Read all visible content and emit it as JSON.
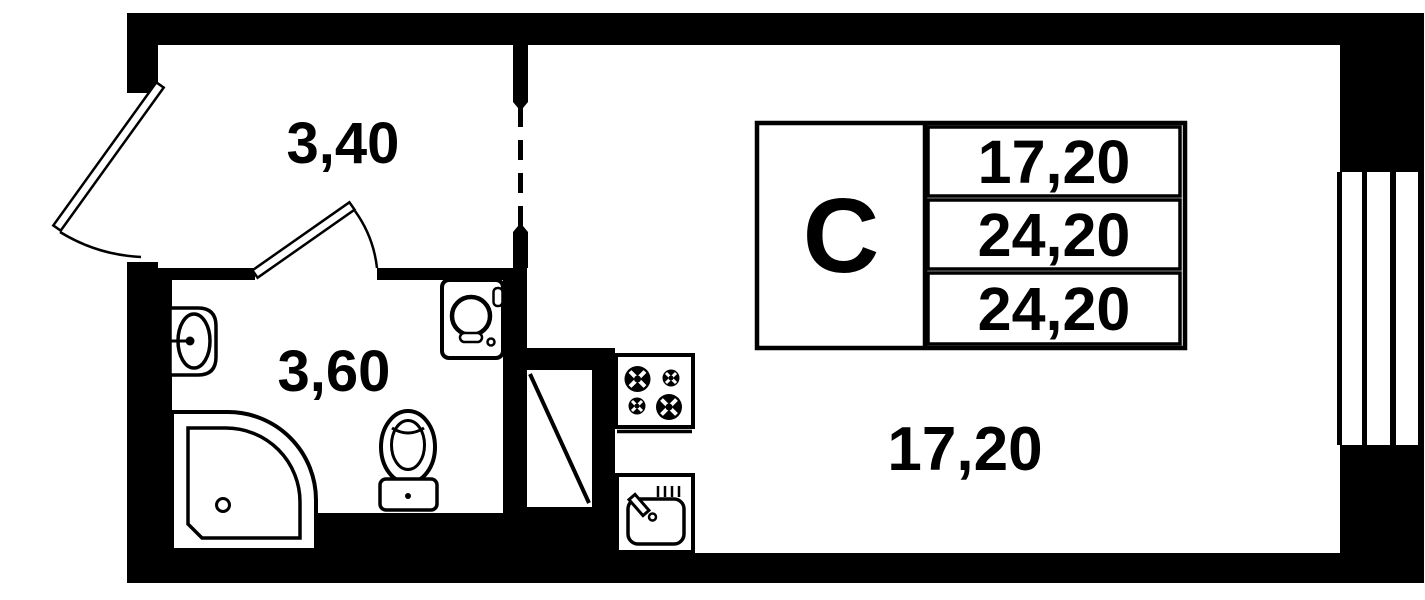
{
  "plan": {
    "labels": {
      "hallway": "3,40",
      "bathroom": "3,60",
      "living_room": "17,20"
    },
    "stamp": {
      "letter": "С",
      "rows": [
        "17,20",
        "24,20",
        "24,20"
      ]
    },
    "colors": {
      "wall": "#000000",
      "background": "#ffffff"
    },
    "fixtures": [
      "entry-door",
      "interior-door",
      "doorway-opening",
      "window",
      "ventilation-shaft",
      "bath-sink",
      "shower-tray",
      "toilet",
      "washing-machine",
      "stove",
      "kitchen-sink"
    ]
  }
}
